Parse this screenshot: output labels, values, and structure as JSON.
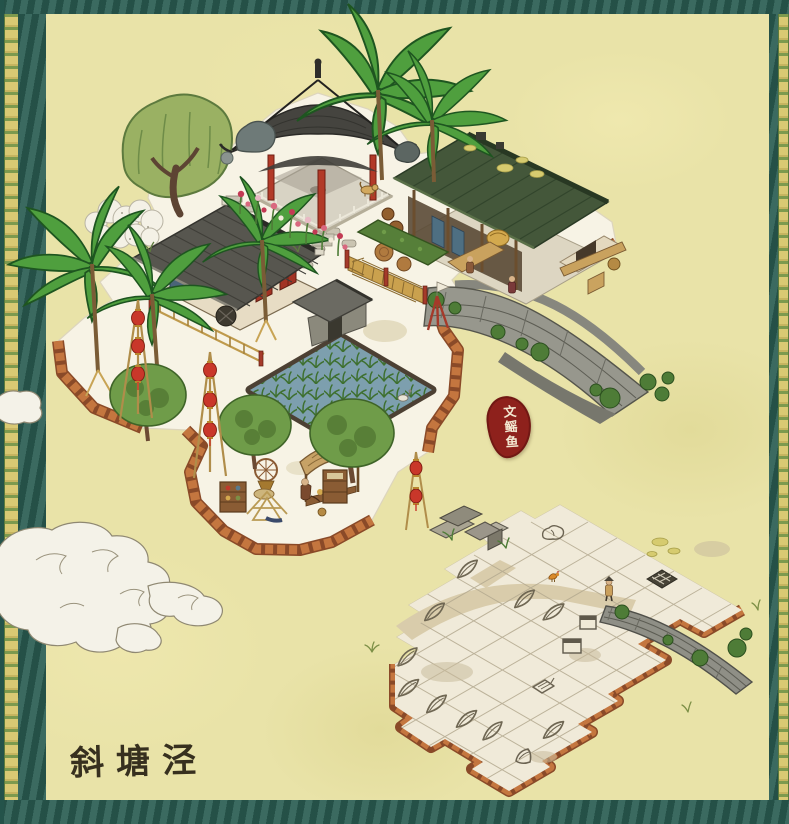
{
  "map": {
    "location_label": "斜塘泾",
    "seal_text": "文鳐鱼",
    "plot_markers": {
      "leaf_marked_plots": 10,
      "other_markers": [
        "scroll",
        "raft-grid",
        "stall-box",
        "stall-box",
        "shell",
        "rock"
      ]
    },
    "colors": {
      "background": "#e9e3a8",
      "border_teal": "#2f6156",
      "bamboo_strip": "#d9c973",
      "terrace_white": "#f7f3e5",
      "cliff_orange": "#c4763f",
      "platform_cream": "#f0ead9",
      "seal_red": "#8e211c",
      "lantern_red": "#c9372a",
      "roof_gray": "#57564f",
      "roof_green": "#44573a",
      "paddy_water": "#7d9fae",
      "label_ink": "#37301f"
    }
  }
}
